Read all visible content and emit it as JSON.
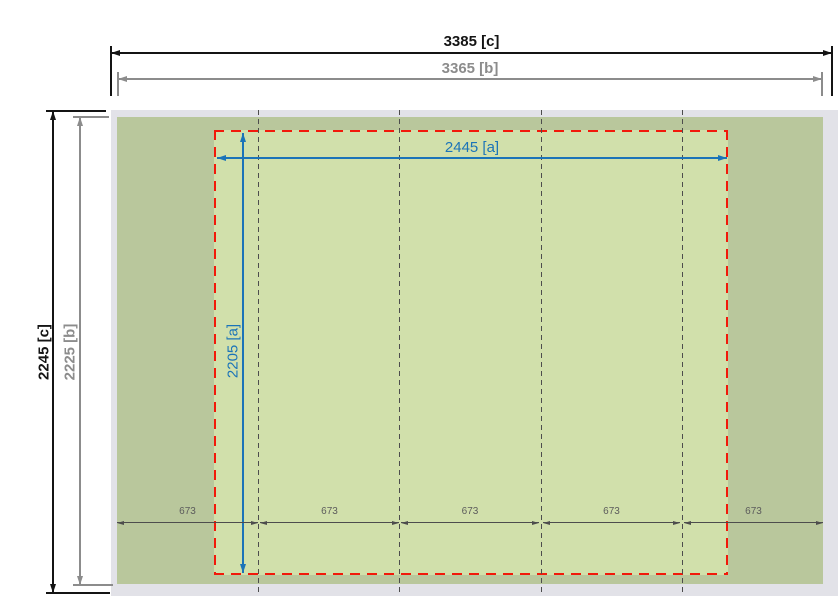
{
  "drawing": {
    "type": "dimension-diagram",
    "horizontal_dims": {
      "outer": "3385 [c]",
      "middle": "3365 [b]",
      "inner": "2445 [a]"
    },
    "vertical_dims": {
      "outer": "2245 [c]",
      "middle": "2225 [b]",
      "inner": "2205 [a]"
    },
    "spacing_labels": [
      "673",
      "673",
      "673",
      "673",
      "673"
    ],
    "colors": {
      "base_gray": "#e2e2e8",
      "body_green": "#b9c79c",
      "inner_green": "#d1e0ab",
      "dim_red": "#f2190a",
      "dim_blue": "#1b74b8",
      "dim_black": "#141414",
      "dim_gray": "#8c8c8c",
      "divider_gray": "#4d4d4d",
      "spacing_text": "#5c5c5c"
    }
  }
}
